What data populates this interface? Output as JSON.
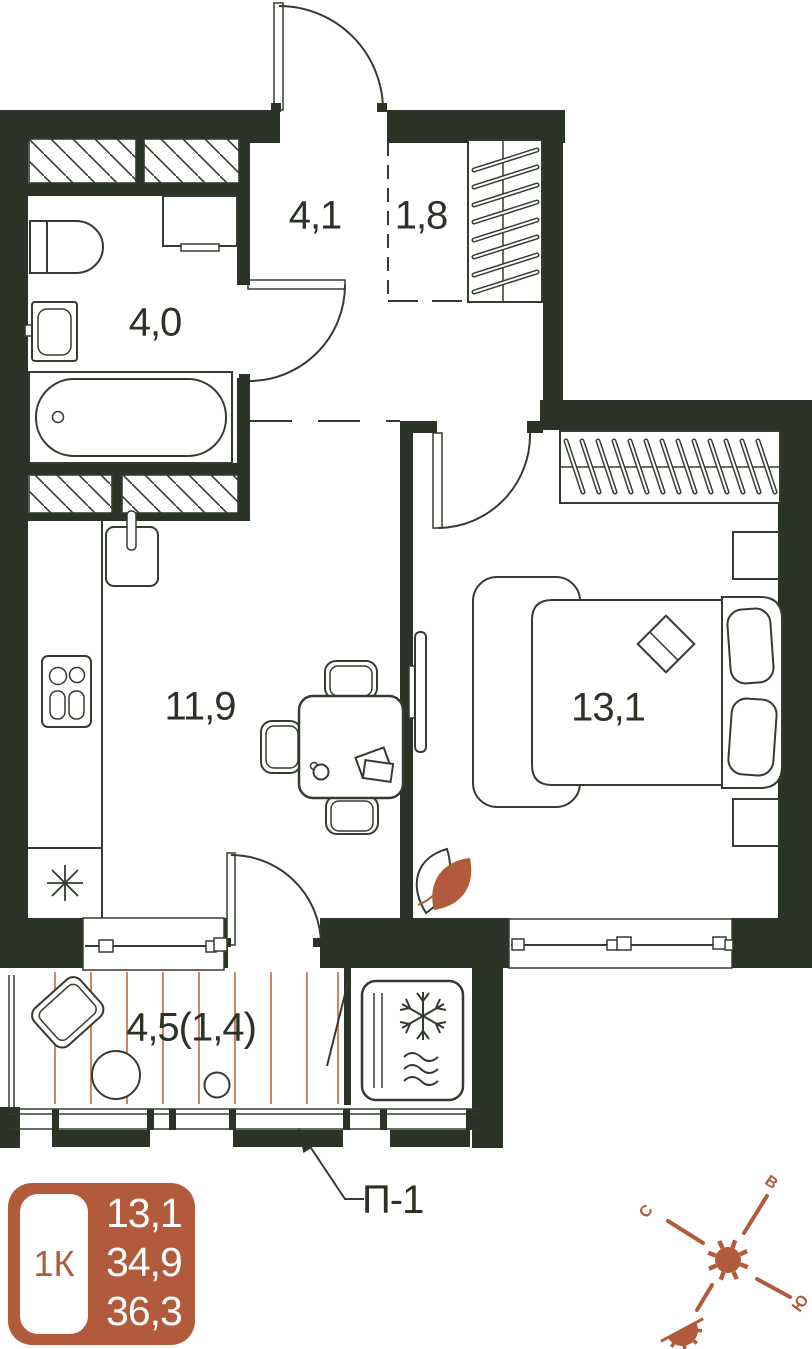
{
  "plan": {
    "title": "1-room apartment floor plan",
    "rooms": {
      "hallway": {
        "name": "hallway",
        "area": "4,1"
      },
      "closet": {
        "name": "closet",
        "area": "1,8"
      },
      "bathroom": {
        "name": "bathroom",
        "area": "4,0"
      },
      "kitchen": {
        "name": "kitchen",
        "area": "11,9"
      },
      "bedroom": {
        "name": "bedroom",
        "area": "13,1"
      },
      "balcony": {
        "name": "balcony",
        "area": "4,5(1,4)"
      }
    },
    "annotations": {
      "panel": "П-1"
    },
    "icons": [
      "entry-door-arc",
      "bath",
      "toilet",
      "sink",
      "washer",
      "stove",
      "fridge-asterisk",
      "dining-table",
      "wardrobe-hangers",
      "double-bed",
      "tv",
      "ac-unit-snowflake",
      "balcony-deck",
      "plant"
    ]
  },
  "legend": {
    "apartment_type": "1К",
    "living_area": "13,1",
    "apartment_area": "34,9",
    "total_area": "36,3"
  },
  "compass": {
    "north": "С",
    "east": "В",
    "south": "Ю"
  },
  "colors": {
    "wall": "#2b3327",
    "line": "#333d2f",
    "accent": "#b15b3c",
    "deck_line": "#d08468",
    "background": "#ffffff"
  }
}
